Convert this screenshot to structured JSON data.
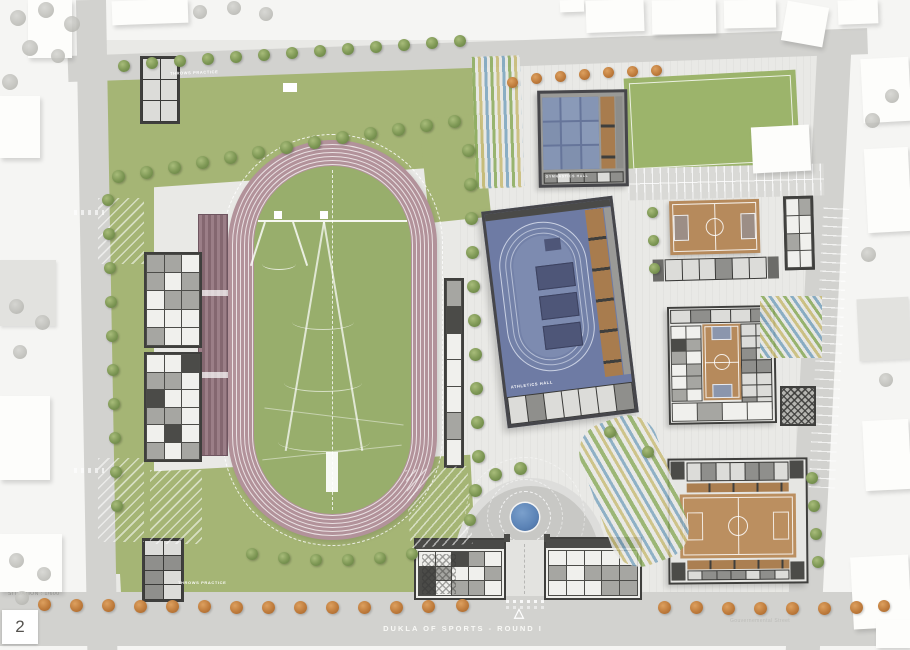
{
  "title": {
    "text": "DUKLA OF SPORTS - ROUND I"
  },
  "footer": {
    "scale_label": "SITUATION : 1/600",
    "page_number": "2",
    "street_label": "Gouvernemental Street"
  },
  "labels": {
    "throws_top": "THROWS PRACTICE",
    "throws_bottom": "THROWS PRACTICE",
    "gym_hall": "GYMNASTICS HALL",
    "athletics_hall": "ATHLETICS HALL"
  },
  "icons": {
    "entrance_arrow": "△",
    "north_compass": "compass-dial"
  },
  "colors": {
    "road": "#d2d2cf",
    "site_paving": "#e9e9e6",
    "lawn": "#a5b575",
    "infield": "#98ae6c",
    "track": "#b2929a",
    "wood_court": "#b68a5c",
    "hall_blue": "#6e7ba4",
    "gym_panel_blue": "#8595b4",
    "fountain_blue": "#5b83b6",
    "tree_green": "#7d9754",
    "tree_orange": "#bf7c3c",
    "walls": "#3f3f3d"
  },
  "scene": {
    "blocks": [
      [
        112,
        0,
        76,
        24,
        -2,
        "w"
      ],
      [
        560,
        0,
        24,
        12,
        -2,
        "w"
      ],
      [
        586,
        0,
        58,
        32,
        -2,
        "w"
      ],
      [
        652,
        0,
        64,
        34,
        -1,
        "w"
      ],
      [
        724,
        0,
        52,
        28,
        -1,
        "w"
      ],
      [
        784,
        4,
        42,
        40,
        10,
        "w"
      ],
      [
        838,
        0,
        40,
        24,
        -2,
        "w"
      ],
      [
        752,
        126,
        58,
        46,
        -3,
        "w"
      ],
      [
        862,
        58,
        48,
        64,
        -3,
        "w"
      ],
      [
        866,
        148,
        44,
        84,
        -3,
        "w"
      ],
      [
        858,
        298,
        52,
        62,
        -3,
        "g"
      ],
      [
        864,
        420,
        46,
        70,
        -3,
        "w"
      ],
      [
        852,
        556,
        58,
        72,
        -3,
        "w"
      ],
      [
        876,
        620,
        34,
        28,
        0,
        "w"
      ],
      [
        28,
        0,
        44,
        58,
        0,
        "w"
      ],
      [
        0,
        96,
        40,
        62,
        0,
        "w"
      ],
      [
        0,
        260,
        56,
        66,
        0,
        "g"
      ],
      [
        0,
        396,
        50,
        84,
        0,
        "w"
      ],
      [
        0,
        534,
        62,
        58,
        0,
        "w"
      ]
    ],
    "trees": {
      "o": [
        [
          44,
          604,
          13
        ],
        [
          76,
          605,
          13
        ],
        [
          108,
          605,
          13
        ],
        [
          140,
          606,
          13
        ],
        [
          172,
          606,
          13
        ],
        [
          204,
          606,
          13
        ],
        [
          236,
          607,
          13
        ],
        [
          268,
          607,
          13
        ],
        [
          300,
          607,
          13
        ],
        [
          332,
          607,
          13
        ],
        [
          364,
          607,
          13
        ],
        [
          396,
          607,
          13
        ],
        [
          428,
          606,
          13
        ],
        [
          462,
          605,
          13
        ],
        [
          664,
          607,
          13
        ],
        [
          696,
          607,
          13
        ],
        [
          728,
          608,
          13
        ],
        [
          760,
          608,
          13
        ],
        [
          792,
          608,
          13
        ],
        [
          824,
          608,
          13
        ],
        [
          856,
          607,
          13
        ],
        [
          884,
          606,
          12
        ],
        [
          512,
          82,
          11
        ],
        [
          536,
          78,
          11
        ],
        [
          560,
          76,
          11
        ],
        [
          584,
          74,
          11
        ],
        [
          608,
          72,
          11
        ],
        [
          632,
          71,
          11
        ],
        [
          656,
          70,
          11
        ]
      ],
      "g": [
        [
          124,
          66,
          12
        ],
        [
          152,
          63,
          12
        ],
        [
          180,
          61,
          12
        ],
        [
          208,
          59,
          12
        ],
        [
          236,
          57,
          12
        ],
        [
          264,
          55,
          12
        ],
        [
          292,
          53,
          12
        ],
        [
          320,
          51,
          12
        ],
        [
          348,
          49,
          12
        ],
        [
          376,
          47,
          12
        ],
        [
          404,
          45,
          12
        ],
        [
          432,
          43,
          12
        ],
        [
          460,
          41,
          12
        ],
        [
          118,
          176,
          13
        ],
        [
          146,
          172,
          13
        ],
        [
          174,
          167,
          13
        ],
        [
          202,
          162,
          13
        ],
        [
          230,
          157,
          13
        ],
        [
          258,
          152,
          13
        ],
        [
          286,
          147,
          13
        ],
        [
          314,
          142,
          13
        ],
        [
          342,
          137,
          13
        ],
        [
          370,
          133,
          13
        ],
        [
          398,
          129,
          13
        ],
        [
          426,
          125,
          13
        ],
        [
          454,
          121,
          13
        ],
        [
          108,
          200,
          12
        ],
        [
          109,
          234,
          12
        ],
        [
          110,
          268,
          12
        ],
        [
          111,
          302,
          12
        ],
        [
          112,
          336,
          12
        ],
        [
          113,
          370,
          12
        ],
        [
          114,
          404,
          12
        ],
        [
          115,
          438,
          12
        ],
        [
          116,
          472,
          12
        ],
        [
          117,
          506,
          12
        ],
        [
          468,
          150,
          13
        ],
        [
          470,
          184,
          13
        ],
        [
          471,
          218,
          13
        ],
        [
          472,
          252,
          13
        ],
        [
          473,
          286,
          13
        ],
        [
          474,
          320,
          13
        ],
        [
          475,
          354,
          13
        ],
        [
          476,
          388,
          13
        ],
        [
          477,
          422,
          13
        ],
        [
          478,
          456,
          13
        ],
        [
          475,
          490,
          13
        ],
        [
          470,
          520,
          12
        ],
        [
          252,
          554,
          12
        ],
        [
          284,
          558,
          12
        ],
        [
          316,
          560,
          12
        ],
        [
          348,
          560,
          12
        ],
        [
          380,
          558,
          12
        ],
        [
          412,
          554,
          12
        ],
        [
          495,
          474,
          13
        ],
        [
          520,
          468,
          13
        ],
        [
          610,
          432,
          12
        ],
        [
          648,
          452,
          12
        ],
        [
          652,
          212,
          11
        ],
        [
          653,
          240,
          11
        ],
        [
          654,
          268,
          11
        ],
        [
          812,
          478,
          12
        ],
        [
          814,
          506,
          12
        ],
        [
          816,
          534,
          12
        ],
        [
          818,
          562,
          12
        ]
      ],
      "f": [
        [
          18,
          18,
          16
        ],
        [
          46,
          10,
          16
        ],
        [
          72,
          24,
          16
        ],
        [
          30,
          48,
          16
        ],
        [
          10,
          82,
          16
        ],
        [
          58,
          56,
          14
        ],
        [
          200,
          12,
          14
        ],
        [
          234,
          8,
          14
        ],
        [
          266,
          14,
          14
        ],
        [
          16,
          306,
          15
        ],
        [
          42,
          322,
          15
        ],
        [
          20,
          352,
          14
        ],
        [
          16,
          560,
          15
        ],
        [
          44,
          574,
          14
        ],
        [
          22,
          598,
          14
        ],
        [
          872,
          120,
          15
        ],
        [
          892,
          96,
          14
        ],
        [
          868,
          254,
          15
        ],
        [
          886,
          380,
          14
        ]
      ]
    },
    "hatches": [
      [
        98,
        198,
        46,
        66,
        0
      ],
      [
        98,
        458,
        46,
        84,
        0
      ],
      [
        150,
        470,
        52,
        74,
        0
      ],
      [
        408,
        468,
        62,
        78,
        -4
      ]
    ],
    "stripes": [
      [
        474,
        56,
        48,
        132,
        -2,
        "sv"
      ],
      [
        760,
        296,
        62,
        62,
        0,
        "sd"
      ],
      [
        594,
        416,
        80,
        150,
        -20,
        "sd2"
      ]
    ],
    "rings": [
      {
        "name": "track-oval",
        "count": 6,
        "step": 4,
        "off": 4,
        "color": "rgba(255,255,255,0.72)"
      },
      {
        "name": "athletics-oval",
        "count": 3,
        "step": 5,
        "off": 5,
        "color": "rgba(235,240,250,0.55)"
      }
    ],
    "rooms": [
      {
        "name": "bld-left-1",
        "cols": 3,
        "rows": 5,
        "seed": 3,
        "mode": "plan"
      },
      {
        "name": "bld-left-2",
        "cols": 3,
        "rows": 6,
        "seed": 7,
        "mode": "plan"
      },
      {
        "name": "bld-topleft",
        "cols": 2,
        "rows": 3,
        "seed": 5,
        "mode": "band"
      },
      {
        "name": "bld-bottomleft",
        "cols": 2,
        "rows": 4,
        "seed": 11,
        "mode": "band"
      },
      {
        "name": "bld-east-stand",
        "cols": 1,
        "rows": 7,
        "seed": 4,
        "mode": "plan"
      },
      {
        "name": "gym-bottom-band",
        "cols": 6,
        "rows": 1,
        "seed": 2,
        "mode": "band"
      },
      {
        "name": "ath-bottom-band",
        "cols": 7,
        "rows": 1,
        "seed": 9,
        "mode": "band"
      },
      {
        "name": "court-ne-band",
        "cols": 6,
        "rows": 1,
        "seed": 6,
        "mode": "band"
      },
      {
        "name": "annex-ne",
        "cols": 2,
        "rows": 4,
        "seed": 8,
        "mode": "plan"
      },
      {
        "name": "bball-top-band",
        "cols": 5,
        "rows": 1,
        "seed": 10,
        "mode": "band"
      },
      {
        "name": "bball-left-col",
        "cols": 2,
        "rows": 6,
        "seed": 12,
        "mode": "plan"
      },
      {
        "name": "bball-right-col",
        "cols": 2,
        "rows": 7,
        "seed": 13,
        "mode": "band"
      },
      {
        "name": "bball-bottom",
        "cols": 4,
        "rows": 1,
        "seed": 14,
        "mode": "plan"
      },
      {
        "name": "hall-se-top-band",
        "cols": 7,
        "rows": 1,
        "seed": 15,
        "mode": "band"
      },
      {
        "name": "hall-se-bottom-band",
        "cols": 7,
        "rows": 1,
        "seed": 16,
        "mode": "band"
      },
      {
        "name": "entrance-left-rooms",
        "cols": 5,
        "rows": 3,
        "seed": 17,
        "mode": "plan"
      },
      {
        "name": "entrance-right-rooms",
        "cols": 5,
        "rows": 3,
        "seed": 18,
        "mode": "plan"
      }
    ]
  }
}
